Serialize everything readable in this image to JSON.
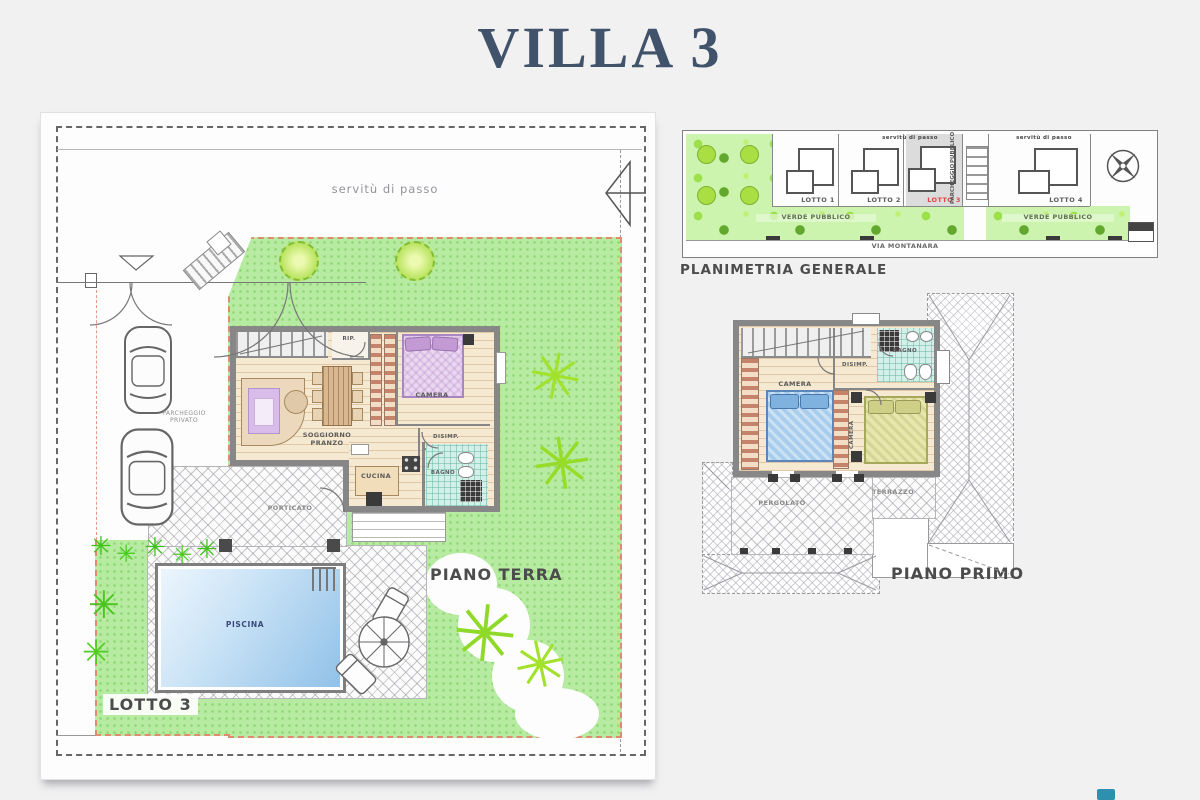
{
  "page": {
    "title": "VILLA 3"
  },
  "icons": {
    "bush_glyph": "✳"
  },
  "ground_floor": {
    "caption": "PIANO TERRA",
    "lot_label": "LOTTO 3",
    "easement": "servitù di passo",
    "parking_line1": "PARCHEGGIO",
    "parking_line2": "PRIVATO",
    "rooms": {
      "storage": "RIP.",
      "bedroom": "CAMERA",
      "living_line1": "SOGGIORNO",
      "living_line2": "PRANZO",
      "hall": "DISIMP.",
      "kitchen": "CUCINA",
      "bath": "BAGNO",
      "porch": "PORTICATO",
      "pool": "PISCINA"
    }
  },
  "master_plan": {
    "caption": "PLANIMETRIA GENERALE",
    "easement_left": "servitù di passo",
    "easement_right": "servitù di passo",
    "lots": [
      {
        "label": "LOTTO 1"
      },
      {
        "label": "LOTTO 2"
      },
      {
        "label": "LOTTO 3",
        "highlighted": true
      },
      {
        "label": "LOTTO 4"
      }
    ],
    "green_left": "VERDE PUBBLICO",
    "green_right": "VERDE PUBBLICO",
    "public_parking_line1": "PARCHEGGIO",
    "public_parking_line2": "PUBBLICO",
    "street": "VIA MONTANARA"
  },
  "first_floor": {
    "caption": "PIANO PRIMO",
    "rooms": {
      "bedroom1": "CAMERA",
      "hall": "DISIMP.",
      "bath": "BAGNO",
      "bedroom2": "CAMERA",
      "pergola": "PERGOLATO",
      "terrace": "TERRAZZO"
    }
  },
  "colors": {
    "title": "#41526b",
    "lot_highlight": "#e04545",
    "grass": "#b6eba1",
    "pool": "#8fc0e8",
    "boundary_red": "#e08a70"
  }
}
